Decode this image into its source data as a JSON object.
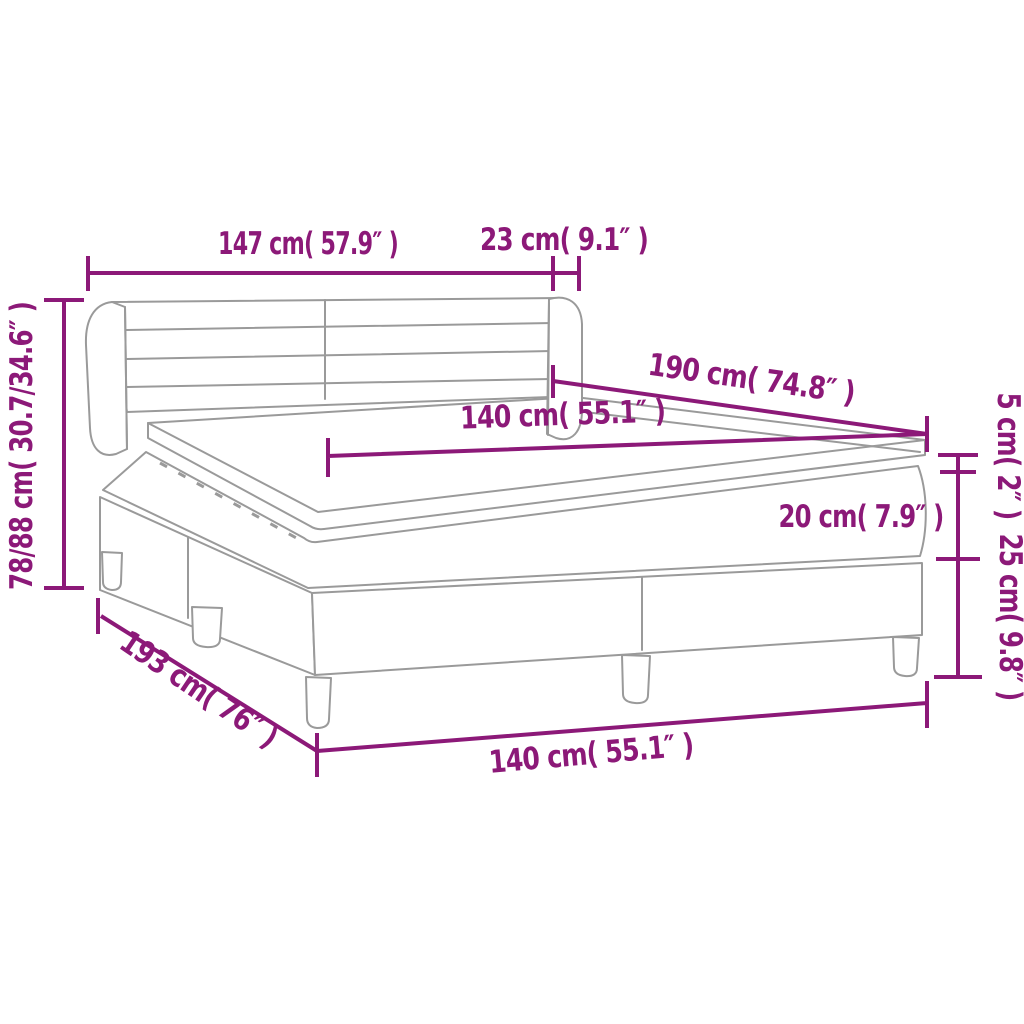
{
  "diagram_title": "box spring bed dimension diagram",
  "colors": {
    "dimension_color": "#8c1978",
    "drawing_line_color": "#9a9a9a",
    "background": "#ffffff"
  },
  "labels": {
    "headboard_width": "147 cm( 57.9″ )",
    "wing_depth": "23 cm( 9.1″ )",
    "total_height": "78/88 cm( 30.7/34.6″ )",
    "length_top": "190 cm( 74.8″ )",
    "width_top": "140 cm( 55.1″ )",
    "topper_height": "5 cm( 2″ )",
    "mattress_height": "20 cm( 7.9″ )",
    "base_height": "25 cm( 9.8″ )",
    "length_bottom": "193 cm( 76″ )",
    "width_bottom": "140 cm( 55.1″ )"
  }
}
